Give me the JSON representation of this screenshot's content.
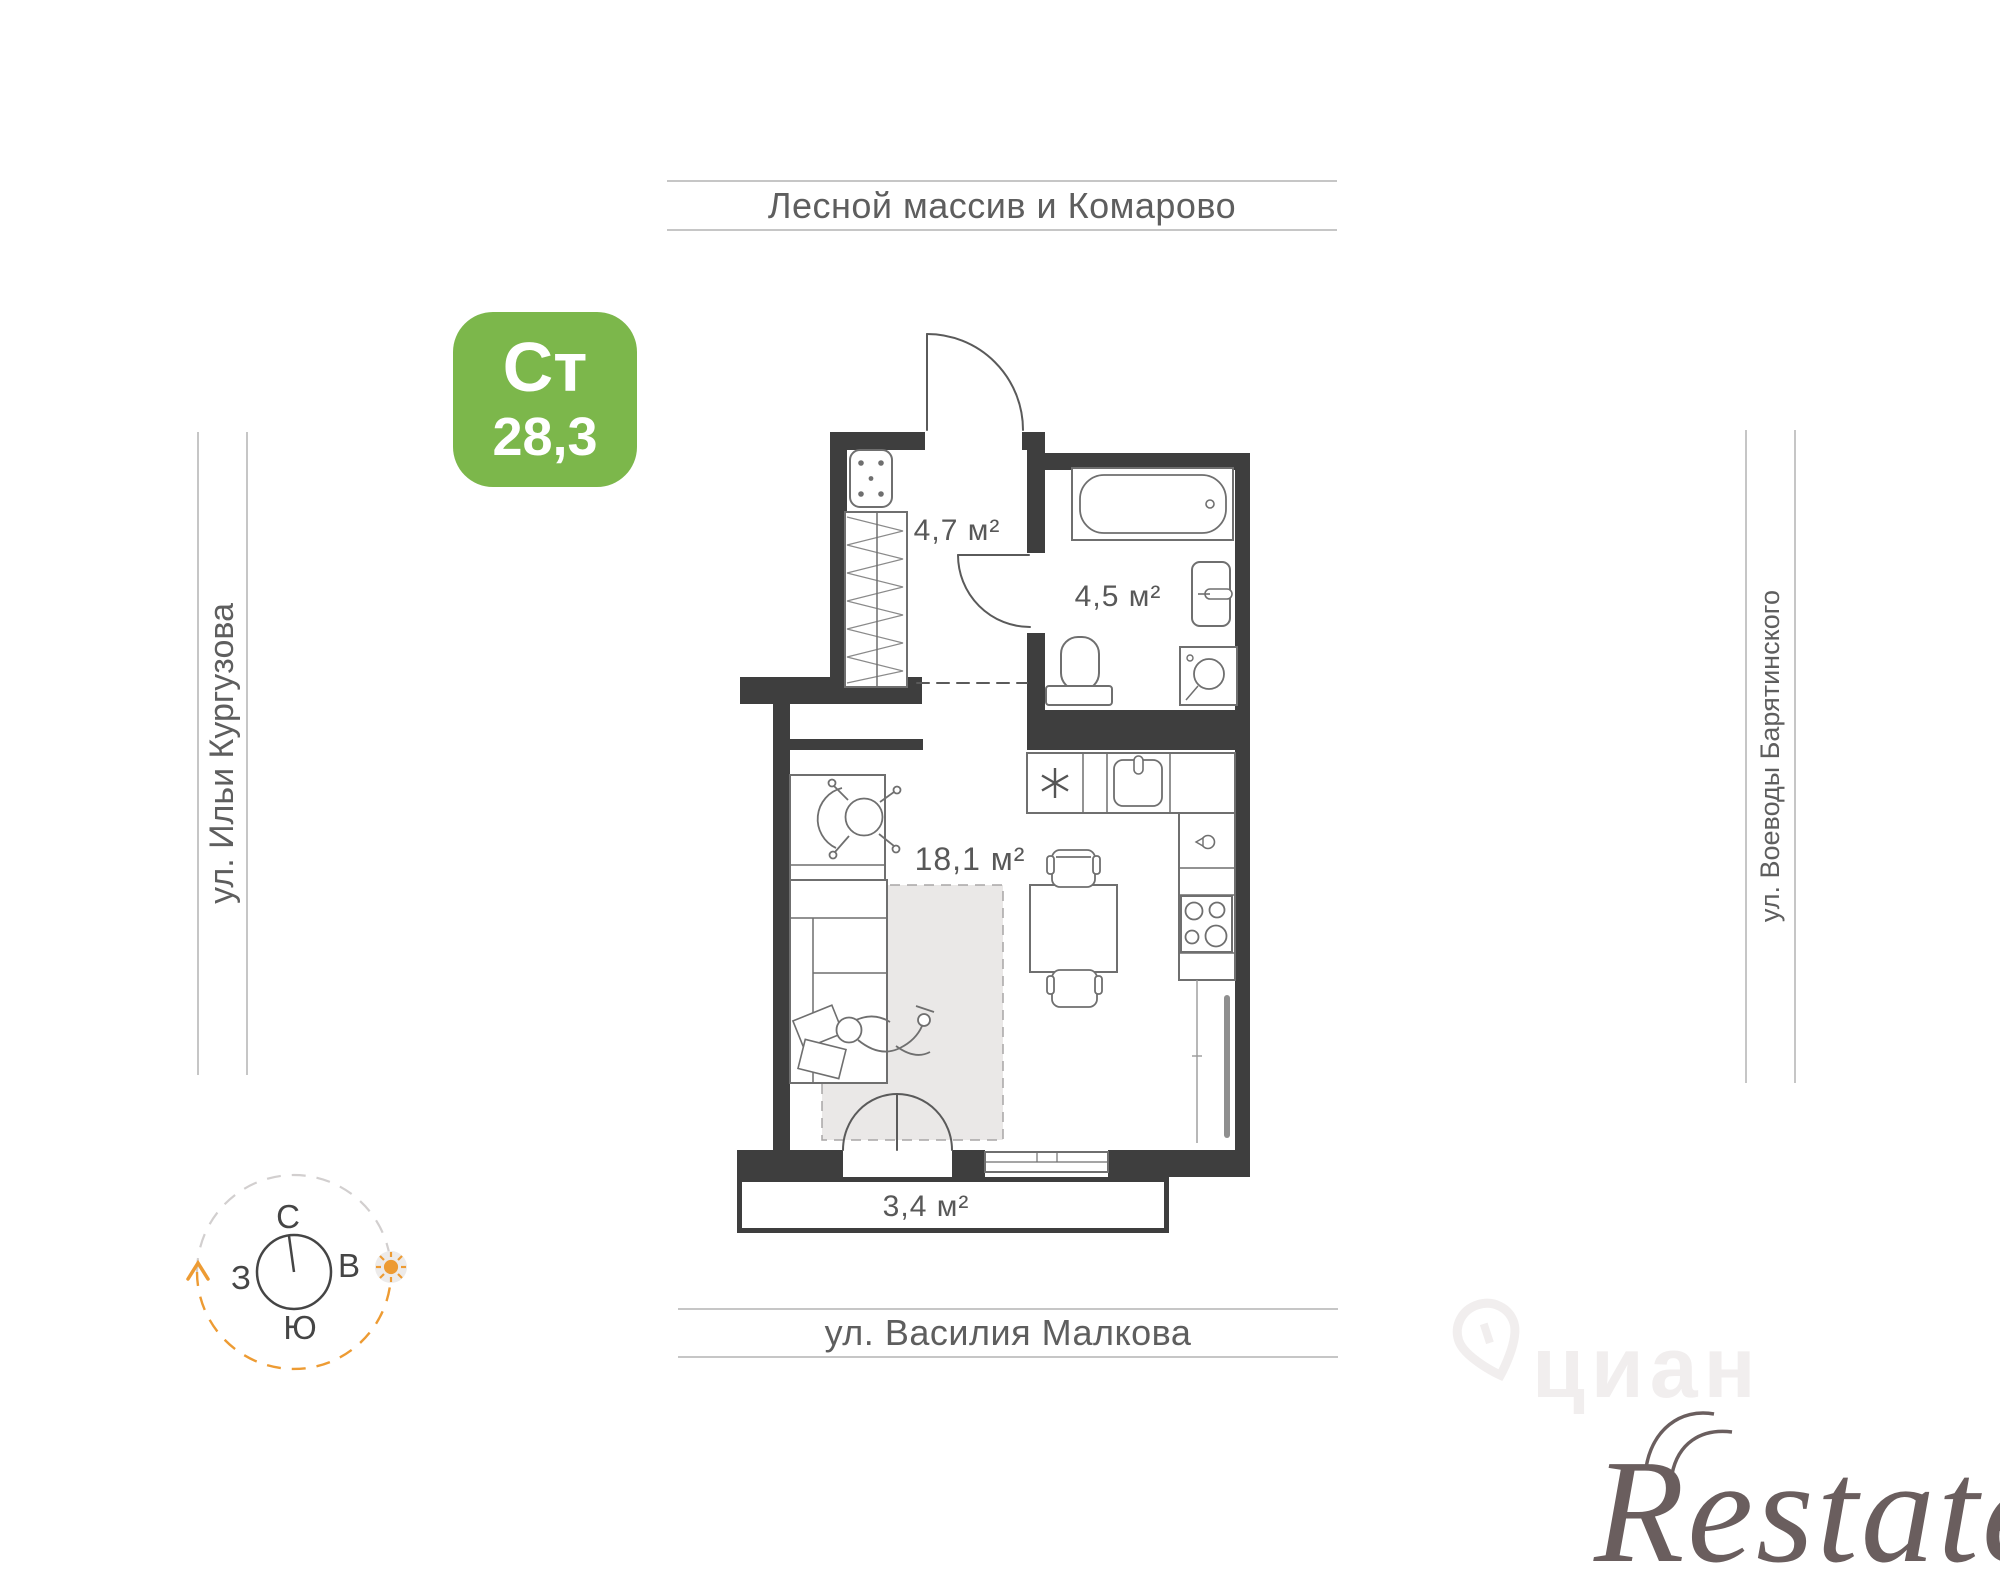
{
  "badge": {
    "type_label": "Ст",
    "area_value": "28,3",
    "color": "#7cb74b"
  },
  "streets": {
    "top": "Лесной массив и Комарово",
    "left": "ул. Ильи Кургузова",
    "right": "ул. Воеводы Барятинского",
    "bottom": "ул. Василия Малкова"
  },
  "floorplan": {
    "wall_color": "#3e3e3e",
    "rooms": [
      {
        "id": "hallway",
        "area_label": "4,7 м²"
      },
      {
        "id": "bathroom",
        "area_label": "4,5 м²"
      },
      {
        "id": "living-room",
        "area_label": "18,1 м²"
      },
      {
        "id": "balcony",
        "area_label": "3,4 м²"
      }
    ]
  },
  "compass": {
    "north": "С",
    "east": "В",
    "south": "Ю",
    "west": "З",
    "accent": "#ED9B33"
  },
  "watermarks": {
    "cian": "циан",
    "restate": "Restate"
  }
}
